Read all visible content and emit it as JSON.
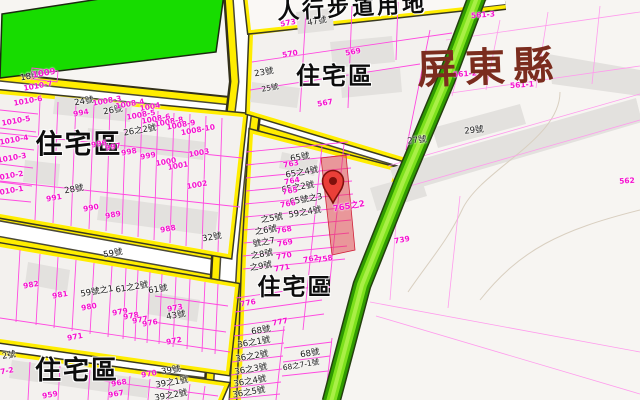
{
  "map": {
    "county_label": "屏東縣",
    "land_use_label": "人行步道用地",
    "selected_parcel": {
      "label": "765之2",
      "marker": "red-map-pin"
    },
    "colors": {
      "road_yellow": "#ffed00",
      "road_white": "#ffffff",
      "park_green": "#17dc00",
      "greenway_green": "#7de11c",
      "parcel_line_magenta": "#ff4ae0",
      "parcel_id_magenta": "#f513cf",
      "county_text": "#7b2c1e",
      "marker_red": "#ea3f38",
      "highlight_red": "#e03e46",
      "building_gray": "#e3e1de",
      "block_fill": "#f3f1ee"
    },
    "label_groups": [
      {
        "name": "zone-label",
        "class": "zone",
        "rot": 0,
        "items": [
          {
            "t": "住宅區",
            "x": 79,
            "y": 145,
            "f": 27
          },
          {
            "t": "住宅區",
            "x": 335,
            "y": 76,
            "f": 24
          },
          {
            "t": "住宅區",
            "x": 295,
            "y": 288,
            "f": 23
          },
          {
            "t": "住宅區",
            "x": 77,
            "y": 371,
            "f": 26
          }
        ]
      },
      {
        "name": "house-number-label",
        "class": "hn",
        "rot": -10,
        "items": [
          {
            "t": "18號",
            "x": 30,
            "y": 77
          },
          {
            "t": "24號",
            "x": 84,
            "y": 102
          },
          {
            "t": "26號",
            "x": 113,
            "y": 111
          },
          {
            "t": "26之2號",
            "x": 140,
            "y": 131
          },
          {
            "t": "28號",
            "x": 74,
            "y": 190
          },
          {
            "t": "32號",
            "x": 212,
            "y": 238
          },
          {
            "t": "23號",
            "x": 264,
            "y": 73
          },
          {
            "t": "47號",
            "x": 317,
            "y": 22
          },
          {
            "t": "25號",
            "x": 270,
            "y": 88,
            "f": 7.5
          },
          {
            "t": "29號",
            "x": 474,
            "y": 131,
            "r": -6
          },
          {
            "t": "27號",
            "x": 417,
            "y": 141,
            "r": -6
          },
          {
            "t": "59號",
            "x": 113,
            "y": 254
          },
          {
            "t": "59號之1",
            "x": 97,
            "y": 292
          },
          {
            "t": "61之2號",
            "x": 132,
            "y": 288
          },
          {
            "t": "61號",
            "x": 158,
            "y": 290
          },
          {
            "t": "43號",
            "x": 176,
            "y": 316
          },
          {
            "t": "39號",
            "x": 171,
            "y": 371
          },
          {
            "t": "39之1號",
            "x": 172,
            "y": 383
          },
          {
            "t": "39之2號",
            "x": 171,
            "y": 396
          },
          {
            "t": "2號",
            "x": 9,
            "y": 356
          },
          {
            "t": "65號",
            "x": 300,
            "y": 158
          },
          {
            "t": "65之4號",
            "x": 302,
            "y": 173
          },
          {
            "t": "65之2號",
            "x": 298,
            "y": 188
          },
          {
            "t": "65號之3",
            "x": 306,
            "y": 200
          },
          {
            "t": "59之4號",
            "x": 305,
            "y": 213
          },
          {
            "t": "之5號",
            "x": 272,
            "y": 219
          },
          {
            "t": "之6號",
            "x": 266,
            "y": 231
          },
          {
            "t": "號之7",
            "x": 264,
            "y": 243
          },
          {
            "t": "之8號",
            "x": 262,
            "y": 255
          },
          {
            "t": "之9號",
            "x": 261,
            "y": 267
          },
          {
            "t": "68號",
            "x": 261,
            "y": 331
          },
          {
            "t": "36之1號",
            "x": 254,
            "y": 343
          },
          {
            "t": "36之2號",
            "x": 252,
            "y": 357
          },
          {
            "t": "36之3號",
            "x": 251,
            "y": 370
          },
          {
            "t": "36之4號",
            "x": 250,
            "y": 382
          },
          {
            "t": "36之5號",
            "x": 249,
            "y": 393
          },
          {
            "t": "68號",
            "x": 310,
            "y": 354
          },
          {
            "t": "68之7-1號",
            "x": 301,
            "y": 365,
            "f": 7.5
          }
        ]
      },
      {
        "name": "parcel-id-label",
        "class": "pid",
        "rot": -10,
        "items": [
          {
            "t": "1009",
            "x": 44,
            "y": 74,
            "f": 8.5
          },
          {
            "t": "1010-7",
            "x": 38,
            "y": 86
          },
          {
            "t": "1010-6",
            "x": 28,
            "y": 101
          },
          {
            "t": "1010-5",
            "x": 16,
            "y": 121
          },
          {
            "t": "1010-4",
            "x": 14,
            "y": 140
          },
          {
            "t": "1010-3",
            "x": 12,
            "y": 158
          },
          {
            "t": "1010-2",
            "x": 9,
            "y": 176
          },
          {
            "t": "1010-1",
            "x": 9,
            "y": 191
          },
          {
            "t": "994",
            "x": 81,
            "y": 113
          },
          {
            "t": "1008-3",
            "x": 107,
            "y": 101
          },
          {
            "t": "1008-4",
            "x": 130,
            "y": 104
          },
          {
            "t": "1004",
            "x": 150,
            "y": 107
          },
          {
            "t": "1008-5",
            "x": 141,
            "y": 115
          },
          {
            "t": "1008-6",
            "x": 156,
            "y": 119
          },
          {
            "t": "1008-8",
            "x": 169,
            "y": 122
          },
          {
            "t": "1008-9",
            "x": 181,
            "y": 125
          },
          {
            "t": "1008-10",
            "x": 198,
            "y": 130
          },
          {
            "t": "996",
            "x": 99,
            "y": 144
          },
          {
            "t": "997",
            "x": 113,
            "y": 147
          },
          {
            "t": "998",
            "x": 129,
            "y": 152
          },
          {
            "t": "999",
            "x": 148,
            "y": 156
          },
          {
            "t": "1000",
            "x": 166,
            "y": 162
          },
          {
            "t": "1001",
            "x": 178,
            "y": 166
          },
          {
            "t": "1003",
            "x": 199,
            "y": 153
          },
          {
            "t": "1002",
            "x": 197,
            "y": 185
          },
          {
            "t": "991",
            "x": 54,
            "y": 198
          },
          {
            "t": "990",
            "x": 91,
            "y": 208
          },
          {
            "t": "989",
            "x": 113,
            "y": 215
          },
          {
            "t": "988",
            "x": 168,
            "y": 229
          },
          {
            "t": "982",
            "x": 31,
            "y": 285
          },
          {
            "t": "981",
            "x": 60,
            "y": 295
          },
          {
            "t": "980",
            "x": 89,
            "y": 307
          },
          {
            "t": "979",
            "x": 120,
            "y": 312
          },
          {
            "t": "978",
            "x": 131,
            "y": 316
          },
          {
            "t": "977",
            "x": 140,
            "y": 320
          },
          {
            "t": "976",
            "x": 150,
            "y": 323
          },
          {
            "t": "973",
            "x": 175,
            "y": 308
          },
          {
            "t": "972",
            "x": 174,
            "y": 341
          },
          {
            "t": "971",
            "x": 75,
            "y": 337
          },
          {
            "t": "970",
            "x": 149,
            "y": 374
          },
          {
            "t": "968",
            "x": 119,
            "y": 383
          },
          {
            "t": "967",
            "x": 116,
            "y": 394
          },
          {
            "t": "959",
            "x": 50,
            "y": 395
          },
          {
            "t": "7-2",
            "x": 7,
            "y": 371
          },
          {
            "t": "763",
            "x": 291,
            "y": 164
          },
          {
            "t": "764",
            "x": 292,
            "y": 181
          },
          {
            "t": "765",
            "x": 290,
            "y": 191
          },
          {
            "t": "766",
            "x": 288,
            "y": 204
          },
          {
            "t": "768",
            "x": 284,
            "y": 230
          },
          {
            "t": "769",
            "x": 285,
            "y": 243
          },
          {
            "t": "770",
            "x": 284,
            "y": 256
          },
          {
            "t": "771",
            "x": 282,
            "y": 268
          },
          {
            "t": "762",
            "x": 311,
            "y": 259
          },
          {
            "t": "758",
            "x": 325,
            "y": 259
          },
          {
            "t": "776",
            "x": 248,
            "y": 303
          },
          {
            "t": "777",
            "x": 280,
            "y": 322
          },
          {
            "t": "739",
            "x": 402,
            "y": 240
          },
          {
            "t": "573",
            "x": 288,
            "y": 23
          },
          {
            "t": "570",
            "x": 290,
            "y": 54
          },
          {
            "t": "569",
            "x": 353,
            "y": 52
          },
          {
            "t": "567",
            "x": 325,
            "y": 103
          },
          {
            "t": "561-3",
            "x": 483,
            "y": 15,
            "r": -4
          },
          {
            "t": "561-2",
            "x": 465,
            "y": 74,
            "r": -4
          },
          {
            "t": "561-1",
            "x": 522,
            "y": 85,
            "r": -4
          },
          {
            "t": "562",
            "x": 627,
            "y": 181,
            "r": -4
          },
          {
            "t": "765之2",
            "x": 349,
            "y": 207,
            "f": 8.5
          }
        ]
      }
    ]
  }
}
